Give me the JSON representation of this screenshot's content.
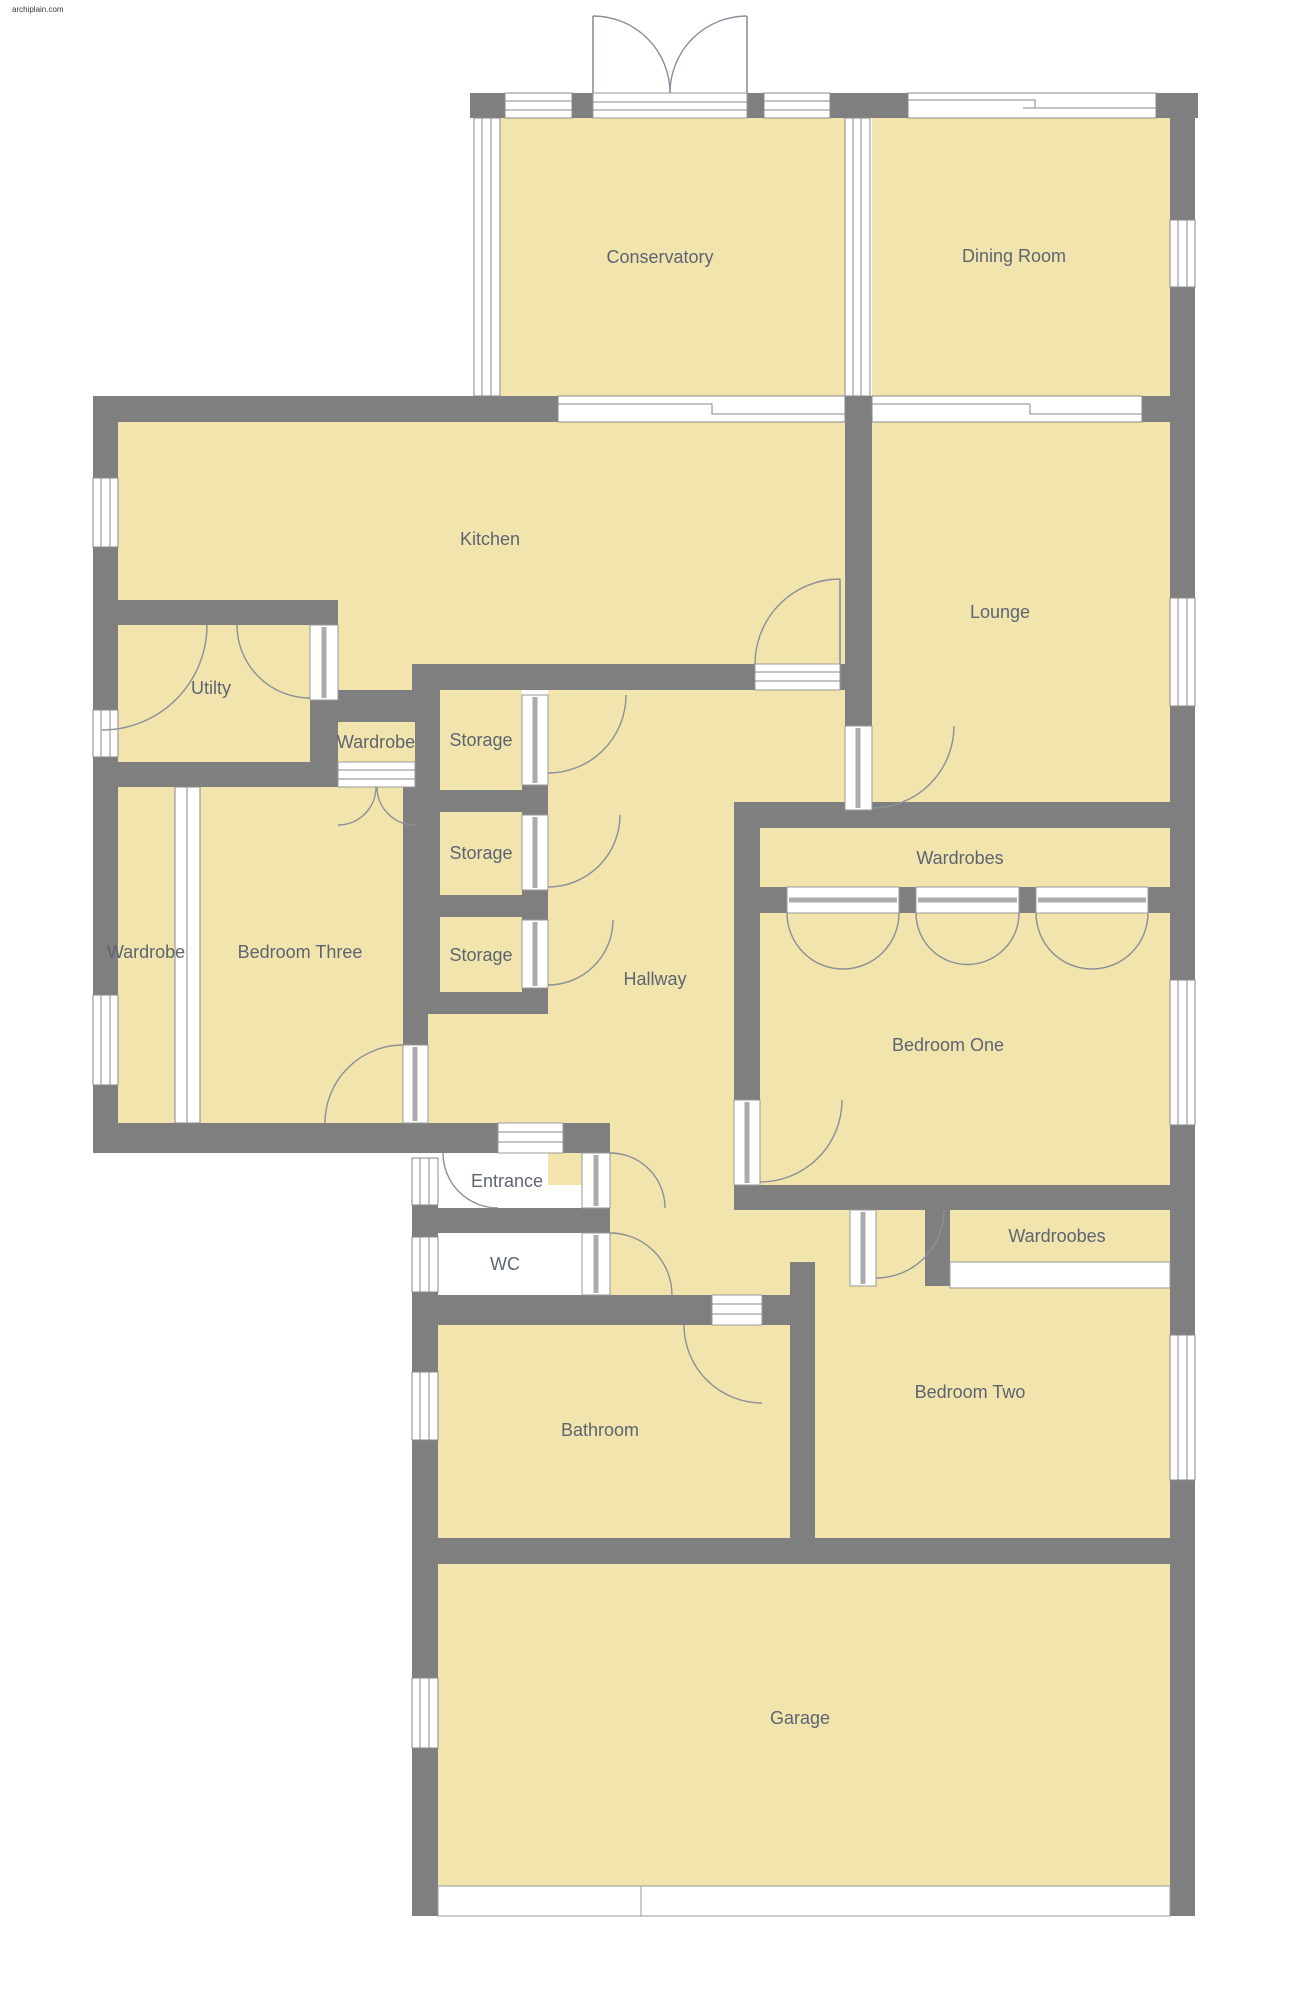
{
  "watermark": "archiplain.com",
  "colors": {
    "floor": "#F1E4AC",
    "wall": "#7F7F7F",
    "window_frame": "#8A8A8A",
    "door_arc": "#8A9099",
    "label_text": "#5D6572",
    "background": "#FFFFFF"
  },
  "rooms": {
    "conservatory": {
      "label": "Conservatory"
    },
    "dining": {
      "label": "Dining Room"
    },
    "kitchen": {
      "label": "Kitchen"
    },
    "lounge": {
      "label": "Lounge"
    },
    "utility": {
      "label": "Utilty"
    },
    "wardrobe_small": {
      "label": "Wardrobe"
    },
    "storage_1": {
      "label": "Storage"
    },
    "storage_2": {
      "label": "Storage"
    },
    "storage_3": {
      "label": "Storage"
    },
    "hallway": {
      "label": "Hallway"
    },
    "wardrobes": {
      "label": "Wardrobes"
    },
    "bedroom_one": {
      "label": "Bedroom One"
    },
    "wardrobe_left": {
      "label": "Wardrobe"
    },
    "bedroom_three": {
      "label": "Bedroom Three"
    },
    "entrance": {
      "label": "Entrance"
    },
    "wc": {
      "label": "WC"
    },
    "wardroobes": {
      "label": "Wardroobes"
    },
    "bedroom_two": {
      "label": "Bedroom Two"
    },
    "bathroom": {
      "label": "Bathroom"
    },
    "garage": {
      "label": "Garage"
    }
  }
}
